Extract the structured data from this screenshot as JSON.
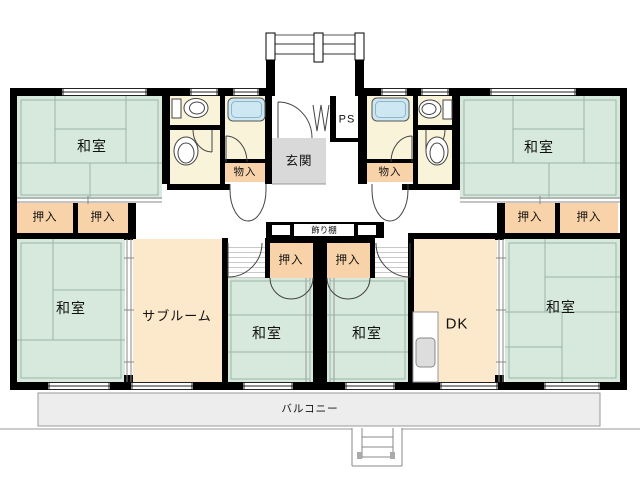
{
  "palette": {
    "wall": "#000000",
    "tatami": "#d6e9dc",
    "tatami_line": "#9cb5a8",
    "closet_peach": "#f8d3a9",
    "room_cream": "#fce8ca",
    "sanitary_yellow": "#f8f3d9",
    "bathtub_blue": "#cde7f3",
    "genkan_gray": "#d9d9d9",
    "balcony_gray": "#ededed",
    "outline_gray": "#888888"
  },
  "rooms": [
    {
      "id": "washitsu-top-left",
      "label": "和室"
    },
    {
      "id": "washitsu-top-right",
      "label": "和室"
    },
    {
      "id": "washitsu-bottom-left",
      "label": "和室"
    },
    {
      "id": "washitsu-center-left",
      "label": "和室"
    },
    {
      "id": "washitsu-center-right",
      "label": "和室"
    },
    {
      "id": "washitsu-bottom-right",
      "label": "和室"
    },
    {
      "id": "subroom",
      "label": "サブルーム"
    },
    {
      "id": "dining-kitchen",
      "label": "DK"
    },
    {
      "id": "entrance",
      "label": "玄関"
    },
    {
      "id": "pipe-space",
      "label": "PS"
    }
  ],
  "closets": [
    {
      "id": "oshiire-top-left-1",
      "label": "押入"
    },
    {
      "id": "oshiire-top-left-2",
      "label": "押入"
    },
    {
      "id": "oshiire-top-right-1",
      "label": "押入"
    },
    {
      "id": "oshiire-top-right-2",
      "label": "押入"
    },
    {
      "id": "oshiire-center-left",
      "label": "押入"
    },
    {
      "id": "oshiire-center-right",
      "label": "押入"
    },
    {
      "id": "monoire-left",
      "label": "物入"
    },
    {
      "id": "monoire-right",
      "label": "物入"
    }
  ],
  "features": {
    "kazaridana": "飾り棚",
    "balcony": "バルコニー"
  }
}
